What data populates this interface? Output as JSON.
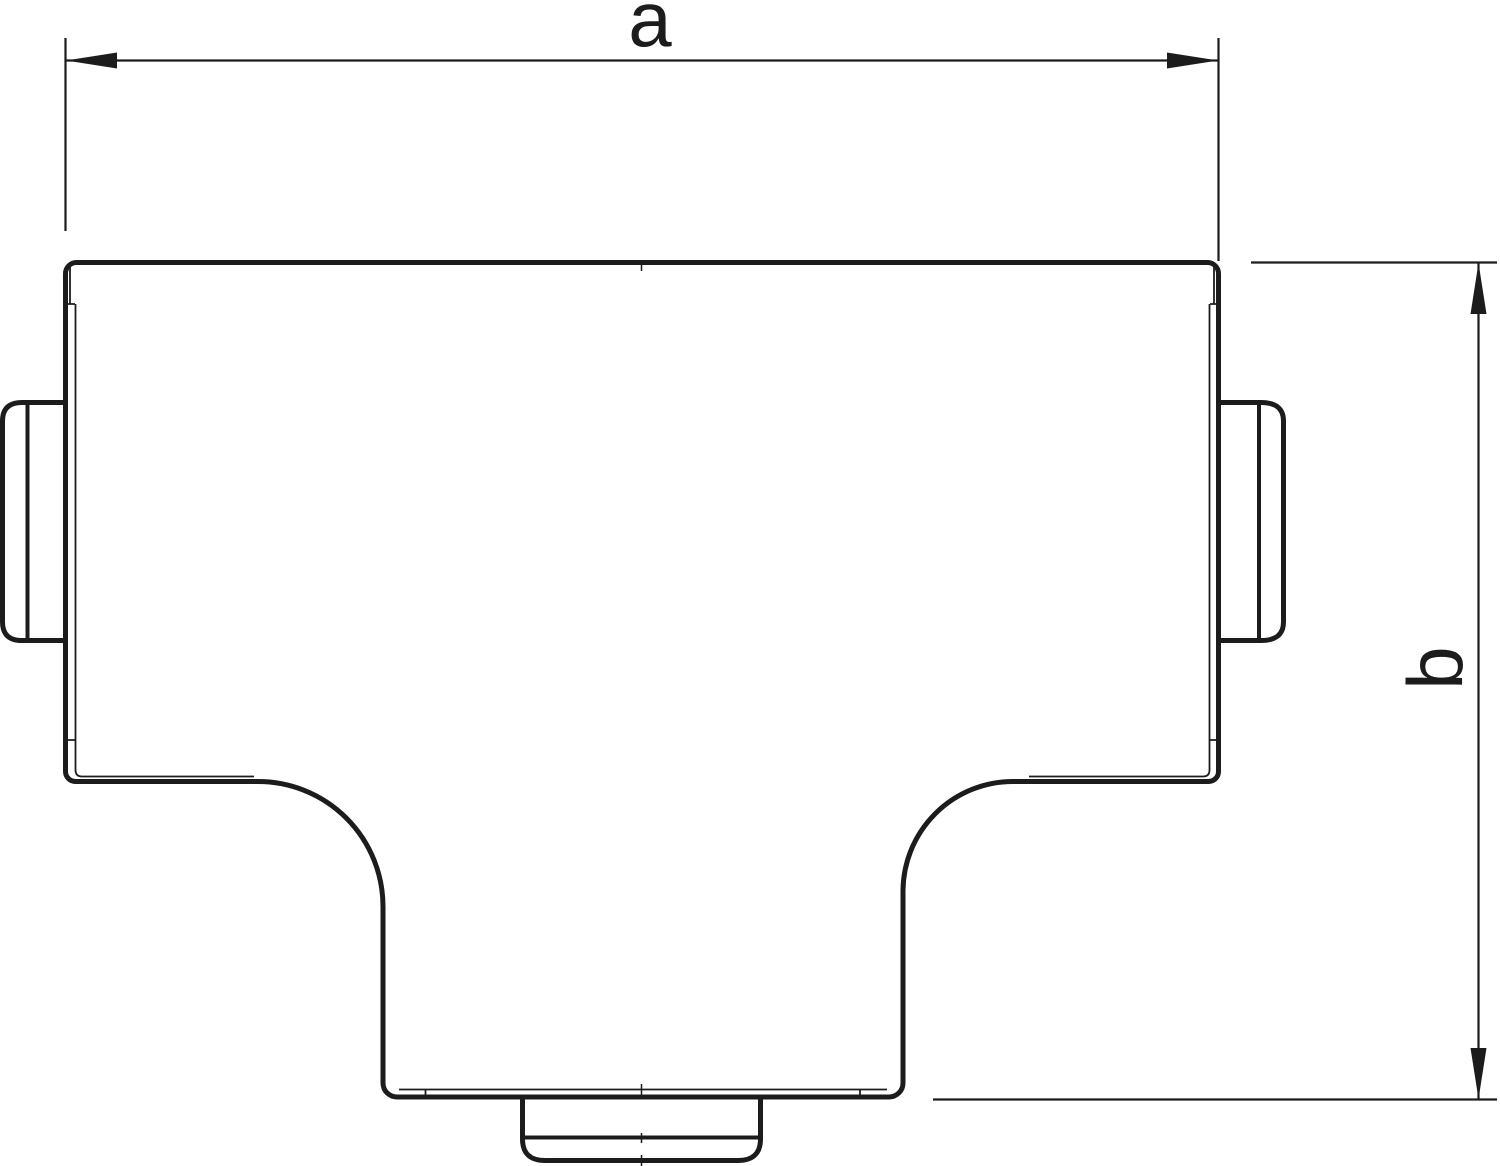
{
  "drawing": {
    "description": "Technical outline drawing (top view) of a T-piece trunking cover with coupling stubs on the left, right and bottom, annotated with two dimension arrows",
    "background_color": "#ffffff",
    "line_color": "#1c1c1c",
    "dimensions": {
      "width_label": "a",
      "height_label": "b"
    }
  }
}
